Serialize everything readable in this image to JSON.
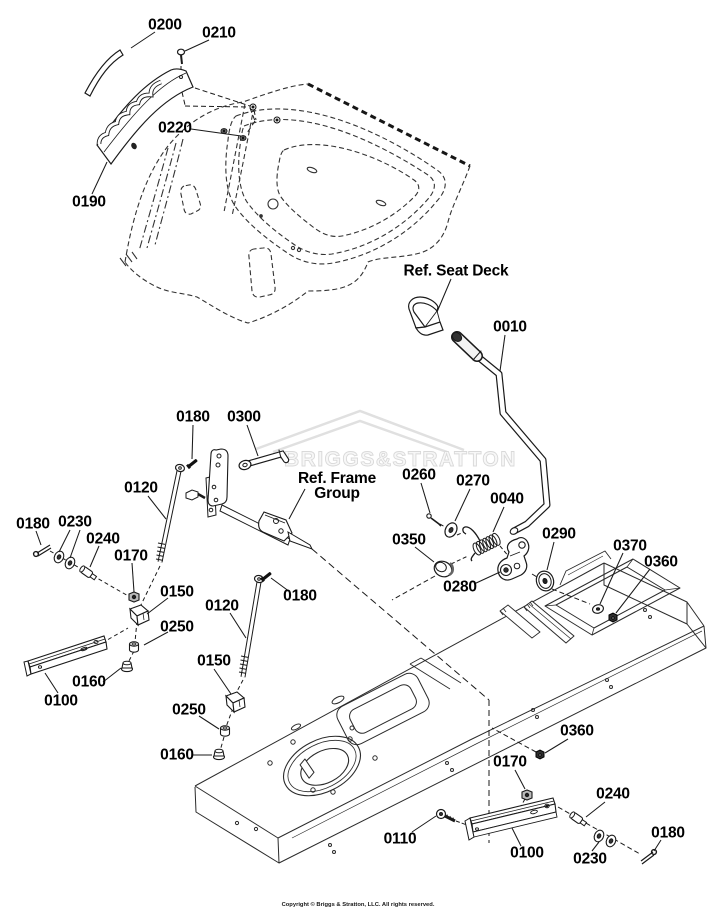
{
  "watermark": {
    "text": "BRIGGS&STRATTON",
    "color": "#dedede"
  },
  "footer": {
    "copyright": "Copyright © Briggs & Stratton, LLC. All rights reserved."
  },
  "callouts": [
    {
      "label": "0200",
      "x": 165,
      "y": 25,
      "leaders": [
        [
          155,
          32,
          131,
          48
        ]
      ]
    },
    {
      "label": "0210",
      "x": 219,
      "y": 33,
      "leaders": [
        [
          209,
          40,
          185,
          51
        ]
      ]
    },
    {
      "label": "0220",
      "x": 175,
      "y": 128,
      "leaders": [
        [
          191,
          129,
          241,
          136
        ]
      ]
    },
    {
      "label": "0190",
      "x": 89,
      "y": 202,
      "leaders": [
        [
          92,
          194,
          107,
          162
        ]
      ]
    },
    {
      "label": "Ref. Seat Deck",
      "x": 456,
      "y": 271,
      "ref": true,
      "leaders": [
        [
          451,
          279,
          437,
          312
        ]
      ]
    },
    {
      "label": "0010",
      "x": 510,
      "y": 327,
      "leaders": [
        [
          505,
          335,
          500,
          371
        ]
      ]
    },
    {
      "label": "0180",
      "x": 193,
      "y": 417,
      "leaders": [
        [
          193,
          425,
          192,
          459
        ]
      ]
    },
    {
      "label": "0300",
      "x": 244,
      "y": 417,
      "leaders": [
        [
          247,
          425,
          258,
          456
        ]
      ]
    },
    {
      "label": "Ref. Frame\nGroup",
      "x": 337,
      "y": 486,
      "ref": true,
      "leaders": [
        [
          305,
          489,
          289,
          519
        ]
      ]
    },
    {
      "label": "0120",
      "x": 141,
      "y": 488,
      "leaders": [
        [
          148,
          496,
          166,
          519
        ]
      ]
    },
    {
      "label": "0260",
      "x": 419,
      "y": 475,
      "leaders": [
        [
          421,
          483,
          430,
          513
        ]
      ]
    },
    {
      "label": "0270",
      "x": 473,
      "y": 481,
      "leaders": [
        [
          470,
          489,
          455,
          521
        ]
      ]
    },
    {
      "label": "0040",
      "x": 507,
      "y": 499,
      "leaders": [
        [
          504,
          507,
          493,
          532
        ]
      ]
    },
    {
      "label": "0180",
      "x": 33,
      "y": 524,
      "leaders": [
        [
          36,
          531,
          41,
          545
        ]
      ]
    },
    {
      "label": "0230",
      "x": 75,
      "y": 522,
      "leaders": [
        [
          70,
          530,
          59,
          552
        ],
        [
          80,
          530,
          70,
          558
        ]
      ]
    },
    {
      "label": "0240",
      "x": 103,
      "y": 539,
      "leaders": [
        [
          99,
          546,
          90,
          567
        ]
      ]
    },
    {
      "label": "0350",
      "x": 409,
      "y": 540,
      "leaders": [
        [
          415,
          547,
          434,
          562
        ]
      ]
    },
    {
      "label": "0170",
      "x": 131,
      "y": 556,
      "leaders": [
        [
          132,
          563,
          134,
          592
        ]
      ]
    },
    {
      "label": "0290",
      "x": 559,
      "y": 534,
      "leaders": [
        [
          554,
          542,
          547,
          570
        ]
      ]
    },
    {
      "label": "0370",
      "x": 630,
      "y": 546,
      "leaders": [
        [
          623,
          553,
          600,
          604
        ]
      ]
    },
    {
      "label": "0360",
      "x": 661,
      "y": 562,
      "leaders": [
        [
          650,
          569,
          616,
          613
        ]
      ]
    },
    {
      "label": "0150",
      "x": 177,
      "y": 592,
      "leaders": [
        [
          168,
          598,
          147,
          614
        ]
      ]
    },
    {
      "label": "0280",
      "x": 460,
      "y": 587,
      "leaders": [
        [
          474,
          584,
          500,
          572
        ]
      ]
    },
    {
      "label": "0120",
      "x": 222,
      "y": 606,
      "leaders": [
        [
          230,
          613,
          246,
          638
        ]
      ]
    },
    {
      "label": "0180",
      "x": 300,
      "y": 596,
      "leaders": [
        [
          290,
          592,
          271,
          578
        ]
      ]
    },
    {
      "label": "0250",
      "x": 177,
      "y": 627,
      "leaders": [
        [
          168,
          632,
          144,
          645
        ]
      ]
    },
    {
      "label": "0160",
      "x": 89,
      "y": 682,
      "leaders": [
        [
          103,
          682,
          121,
          668
        ]
      ]
    },
    {
      "label": "0100",
      "x": 61,
      "y": 701,
      "leaders": [
        [
          58,
          693,
          45,
          673
        ]
      ]
    },
    {
      "label": "0150",
      "x": 214,
      "y": 661,
      "leaders": [
        [
          214,
          669,
          231,
          694
        ]
      ]
    },
    {
      "label": "0250",
      "x": 189,
      "y": 710,
      "leaders": [
        [
          199,
          716,
          219,
          729
        ]
      ]
    },
    {
      "label": "0160",
      "x": 177,
      "y": 755,
      "leaders": [
        [
          192,
          755,
          212,
          755
        ]
      ]
    },
    {
      "label": "0360",
      "x": 577,
      "y": 731,
      "leaders": [
        [
          568,
          739,
          545,
          753
        ]
      ]
    },
    {
      "label": "0170",
      "x": 510,
      "y": 762,
      "leaders": [
        [
          515,
          770,
          525,
          789
        ]
      ]
    },
    {
      "label": "0110",
      "x": 400,
      "y": 839,
      "leaders": [
        [
          412,
          832,
          436,
          816
        ]
      ]
    },
    {
      "label": "0100",
      "x": 527,
      "y": 853,
      "leaders": [
        [
          521,
          846,
          512,
          828
        ]
      ]
    },
    {
      "label": "0240",
      "x": 613,
      "y": 794,
      "leaders": [
        [
          605,
          802,
          586,
          817
        ]
      ]
    },
    {
      "label": "0230",
      "x": 590,
      "y": 859,
      "leaders": [
        [
          592,
          851,
          599,
          842
        ]
      ]
    },
    {
      "label": "0180",
      "x": 668,
      "y": 833,
      "leaders": [
        [
          661,
          840,
          654,
          851
        ]
      ]
    }
  ]
}
